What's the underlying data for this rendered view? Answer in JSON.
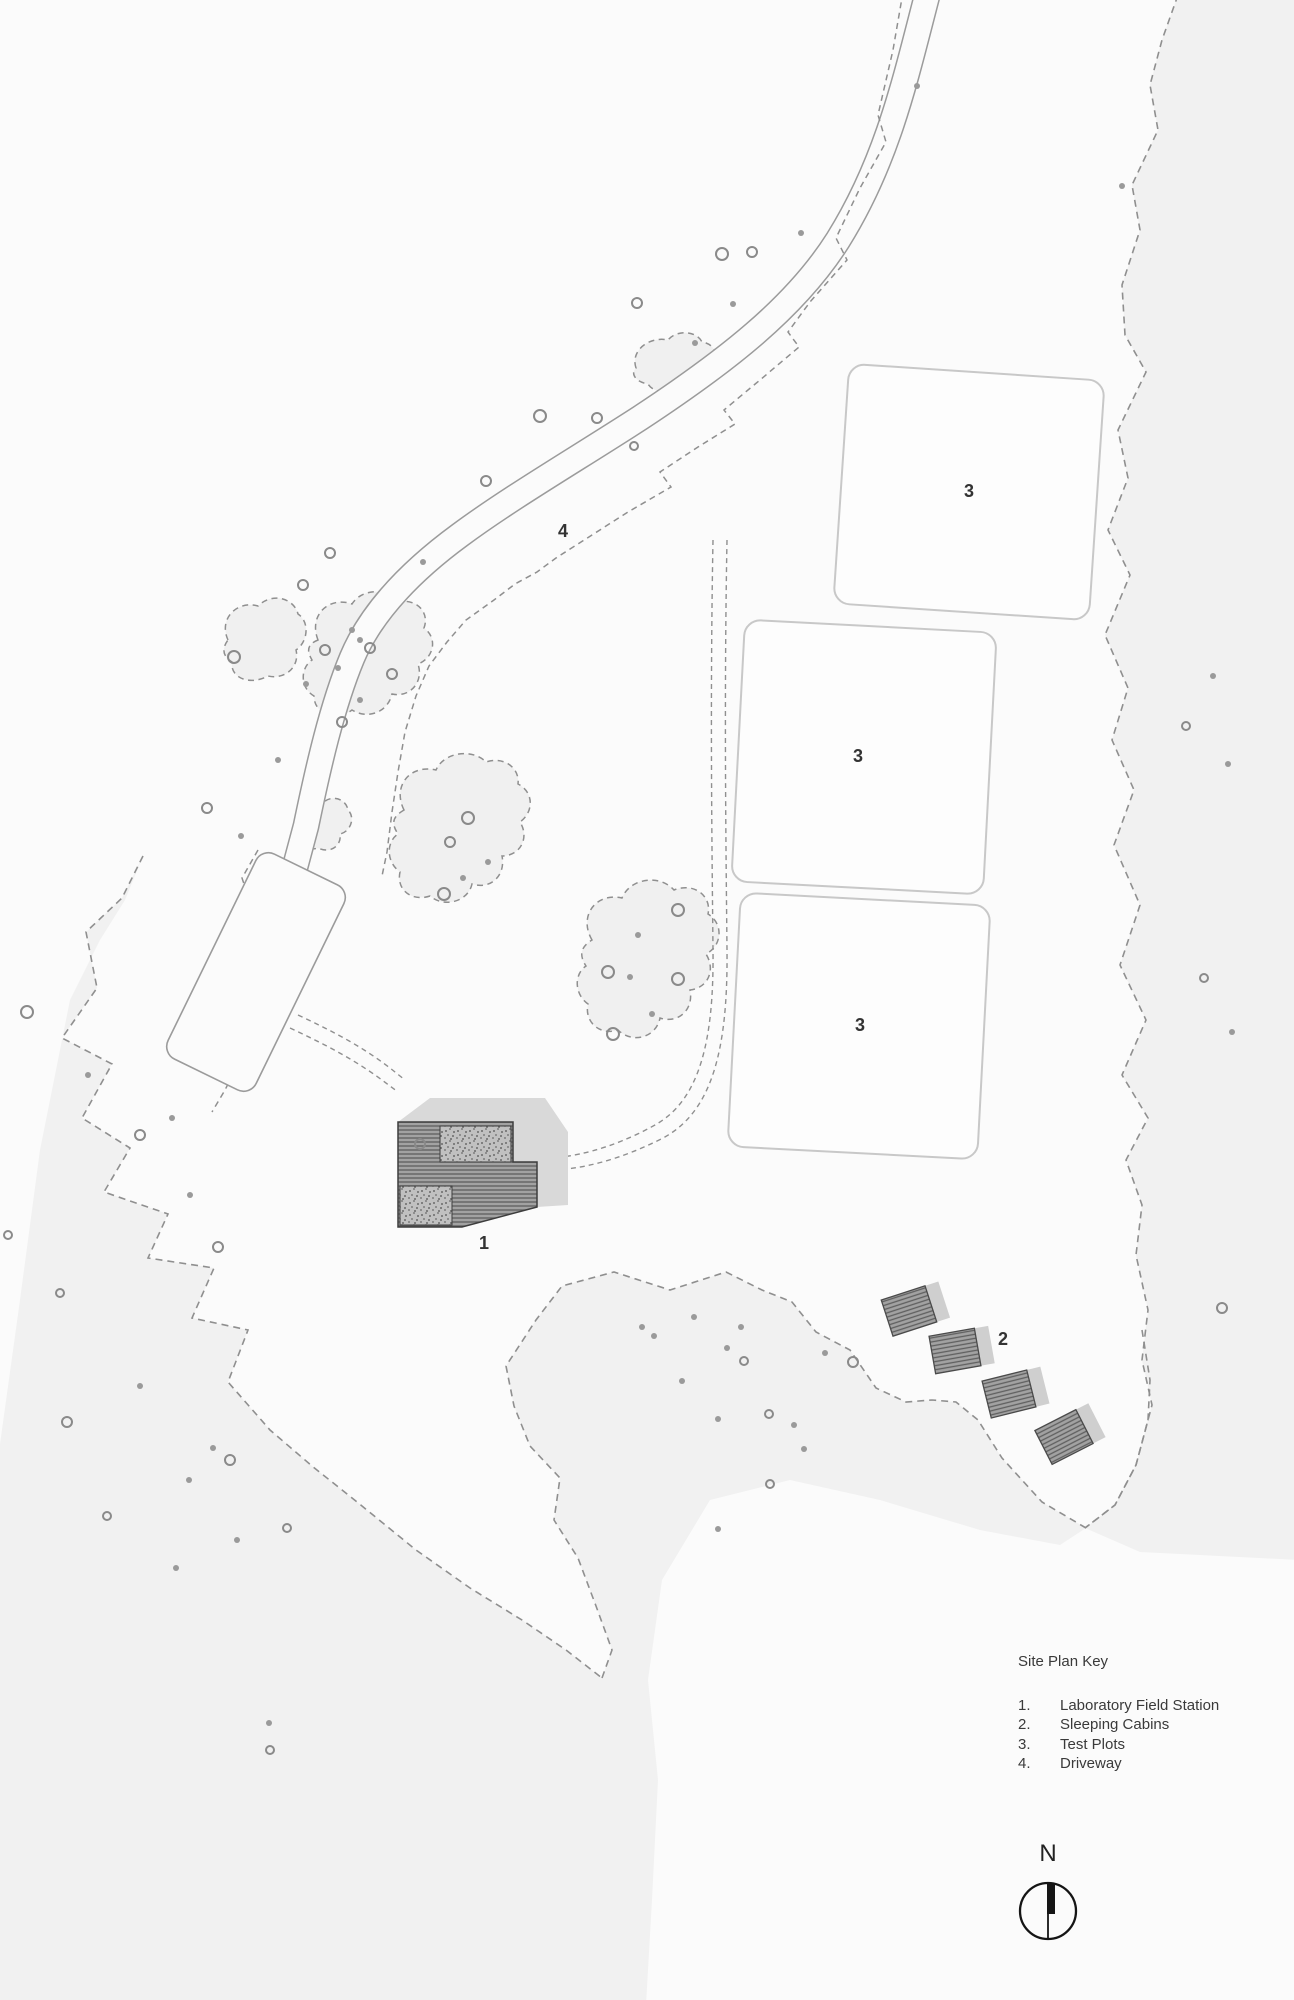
{
  "map_labels": {
    "building": "1",
    "cabins": "2",
    "plot": "3",
    "driveway": "4"
  },
  "key": {
    "title": "Site Plan Key",
    "items": [
      {
        "num": "1.",
        "label": "Laboratory Field Station"
      },
      {
        "num": "2.",
        "label": "Sleeping Cabins"
      },
      {
        "num": "3.",
        "label": "Test Plots"
      },
      {
        "num": "4.",
        "label": "Driveway"
      }
    ]
  },
  "north": {
    "letter": "N"
  },
  "colors": {
    "site_fill": "#fbfbfb",
    "forest_fill": "#f1f1f1",
    "tree_blob_fill": "#f0f0f0",
    "dashed_line": "#8f8f8f",
    "road_line": "#9b9b9b",
    "plot_outline": "#c8c8c8",
    "building_outline": "#3d3d3d",
    "building_hatch_base": "#a2a2a2",
    "building_hatch_line": "#5f5f5f",
    "stipple_base": "#c0c0c0",
    "shadow": "#d9d9d9",
    "text": "#3a3a3a"
  }
}
